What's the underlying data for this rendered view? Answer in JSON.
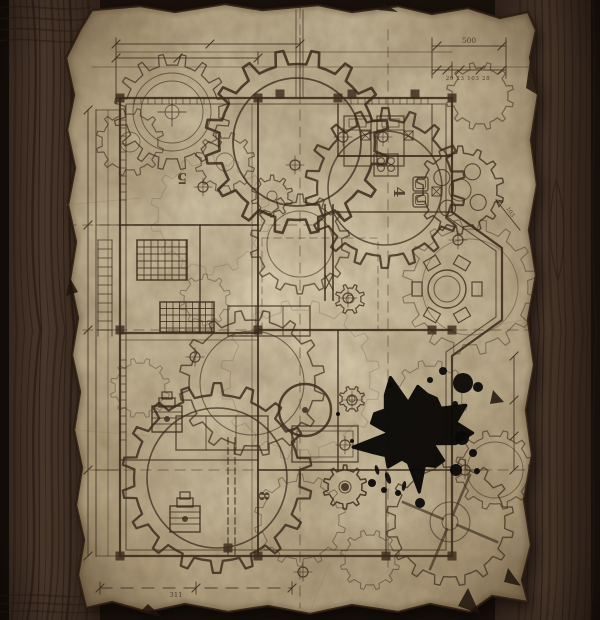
{
  "scene": {
    "type": "steampunk-blueprint-floor-plan-on-wooden-table",
    "colors": {
      "wood_base": "#44332a",
      "wood_dark": "#241812",
      "wood_seam": "#0f0a06",
      "wood_grain": "#271a11",
      "parchment_light": "#dbcfb2",
      "parchment_mid": "#c9ba98",
      "parchment_dark": "#a8916c",
      "parchment_edge": "#2a1b10",
      "ink_line": "#3b2b1c",
      "ink_bold": "#2a1c10",
      "ink_splat": "#0c0a08"
    },
    "room_numbers": [
      {
        "text": "5",
        "x": 182,
        "y": 183,
        "rotate": 180
      },
      {
        "text": "4",
        "x": 399,
        "y": 197,
        "rotate": 90
      },
      {
        "text": "8",
        "x": 264,
        "y": 501,
        "rotate": 90
      }
    ],
    "dimension_labels": [
      {
        "text": "500",
        "x": 469,
        "y": 43
      },
      {
        "text": "20 23 103 28",
        "x": 468,
        "y": 80
      },
      {
        "text": "311",
        "x": 176,
        "y": 597
      },
      {
        "text": "103",
        "x": 509,
        "y": 213,
        "rotate": 55
      }
    ],
    "gears": [
      {
        "cx": 172,
        "cy": 112,
        "tip": 58,
        "root": 47,
        "teeth": 16,
        "w": 1.3,
        "o": 0.7,
        "rings": [
          39,
          31,
          7
        ],
        "cross": true
      },
      {
        "cx": 297,
        "cy": 142,
        "tip": 92,
        "root": 78,
        "teeth": 16,
        "w": 2.6,
        "o": 0.85,
        "rings": [
          64
        ]
      },
      {
        "cx": 385,
        "cy": 188,
        "tip": 80,
        "root": 68,
        "teeth": 18,
        "w": 2.2,
        "o": 0.8,
        "rings": [
          57
        ]
      },
      {
        "cx": 225,
        "cy": 162,
        "tip": 30,
        "root": 24,
        "teeth": 12,
        "w": 1.2,
        "o": 0.6,
        "rings": [
          9
        ]
      },
      {
        "cx": 272,
        "cy": 196,
        "tip": 21,
        "root": 16,
        "teeth": 10,
        "w": 1.2,
        "o": 0.7,
        "rings": [
          5
        ]
      },
      {
        "cx": 300,
        "cy": 244,
        "tip": 50,
        "root": 42,
        "teeth": 14,
        "w": 1.5,
        "o": 0.65,
        "rings": [
          33
        ]
      },
      {
        "cx": 460,
        "cy": 190,
        "tip": 44,
        "root": 37,
        "teeth": 14,
        "w": 1.5,
        "o": 0.75,
        "rings": [
          11
        ],
        "holes": {
          "n": 4,
          "r": 8,
          "at": 22
        }
      },
      {
        "cx": 470,
        "cy": 287,
        "tip": 68,
        "root": 58,
        "teeth": 16,
        "w": 1.1,
        "o": 0.45,
        "rings": [
          48
        ]
      },
      {
        "cx": 252,
        "cy": 383,
        "tip": 73,
        "root": 63,
        "teeth": 16,
        "w": 1.5,
        "o": 0.7,
        "rings": [
          52
        ]
      },
      {
        "cx": 217,
        "cy": 478,
        "tip": 95,
        "root": 83,
        "teeth": 18,
        "w": 2.3,
        "o": 0.82,
        "rings": [
          70
        ]
      },
      {
        "cx": 450,
        "cy": 522,
        "tip": 64,
        "root": 55,
        "teeth": 16,
        "w": 1.4,
        "o": 0.7,
        "rings": [
          20,
          8
        ],
        "spokes": 4
      },
      {
        "cx": 350,
        "cy": 299,
        "tip": 15,
        "root": 11,
        "teeth": 8,
        "w": 1.2,
        "o": 0.8,
        "rings": [
          4
        ]
      },
      {
        "cx": 352,
        "cy": 399,
        "tip": 13,
        "root": 10,
        "teeth": 8,
        "w": 1.2,
        "o": 0.8,
        "rings": [
          3
        ]
      },
      {
        "cx": 345,
        "cy": 487,
        "tip": 22,
        "root": 17,
        "teeth": 10,
        "w": 1.5,
        "o": 0.85,
        "rings": [
          6
        ],
        "hub": 4
      },
      {
        "cx": 140,
        "cy": 388,
        "tip": 30,
        "root": 25,
        "teeth": 12,
        "w": 1,
        "o": 0.4,
        "rings": []
      },
      {
        "cx": 300,
        "cy": 520,
        "tip": 46,
        "root": 39,
        "teeth": 14,
        "w": 1,
        "o": 0.45,
        "rings": []
      },
      {
        "cx": 430,
        "cy": 398,
        "tip": 38,
        "root": 32,
        "teeth": 12,
        "w": 1,
        "o": 0.4,
        "rings": []
      },
      {
        "cx": 480,
        "cy": 96,
        "tip": 34,
        "root": 28,
        "teeth": 12,
        "w": 1.2,
        "o": 0.55,
        "rings": []
      },
      {
        "cx": 130,
        "cy": 142,
        "tip": 34,
        "root": 28,
        "teeth": 12,
        "w": 1.2,
        "o": 0.6,
        "rings": [
          10
        ]
      },
      {
        "cx": 205,
        "cy": 300,
        "tip": 26,
        "root": 21,
        "teeth": 10,
        "w": 1,
        "o": 0.4,
        "rings": []
      },
      {
        "cx": 495,
        "cy": 470,
        "tip": 40,
        "root": 34,
        "teeth": 12,
        "w": 1.2,
        "o": 0.6,
        "rings": [
          28
        ]
      },
      {
        "cx": 370,
        "cy": 560,
        "tip": 30,
        "root": 25,
        "teeth": 12,
        "w": 1,
        "o": 0.5,
        "rings": []
      },
      {
        "cx": 300,
        "cy": 380,
        "tip": 80,
        "root": 70,
        "teeth": 16,
        "w": 1,
        "o": 0.2,
        "rings": []
      },
      {
        "cx": 210,
        "cy": 215,
        "tip": 60,
        "root": 52,
        "teeth": 14,
        "w": 1,
        "o": 0.18,
        "rings": []
      }
    ],
    "ink_splat": {
      "cx": 412,
      "cy": 433,
      "r": 46,
      "drops": [
        [
          463,
          383,
          10
        ],
        [
          478,
          387,
          5
        ],
        [
          455,
          404,
          3
        ],
        [
          443,
          371,
          4
        ],
        [
          372,
          483,
          4
        ],
        [
          384,
          490,
          3
        ],
        [
          398,
          493,
          3
        ],
        [
          456,
          470,
          6
        ],
        [
          477,
          471,
          3
        ],
        [
          420,
          503,
          5
        ],
        [
          352,
          441,
          2
        ],
        [
          338,
          414,
          2
        ],
        [
          462,
          438,
          7
        ],
        [
          473,
          453,
          4
        ],
        [
          430,
          380,
          3
        ],
        [
          390,
          385,
          3
        ]
      ]
    }
  }
}
